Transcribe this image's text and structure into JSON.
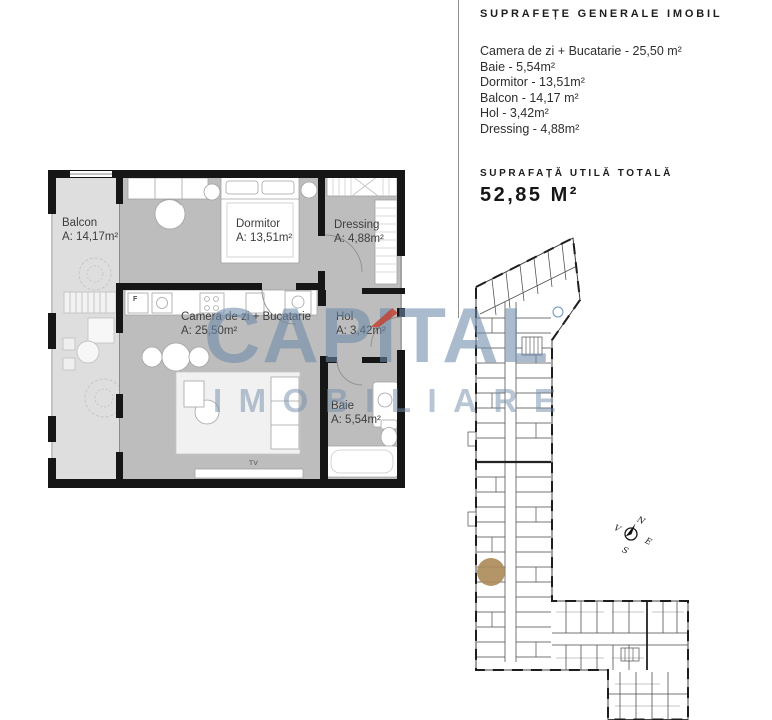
{
  "panel": {
    "title": "SUPRAFEȚE GENERALE IMOBIL",
    "items": [
      "Camera de zi + Bucatarie - 25,50 m²",
      "Baie - 5,54m²",
      "Dormitor - 13,51m²",
      "Balcon - 14,17 m²",
      "Hol - 3,42m²",
      "Dressing - 4,88m²"
    ],
    "total_label": "SUPRAFAȚĂ UTILĂ TOTALĂ",
    "total_value": "52,85 M²"
  },
  "floorplan": {
    "rooms": [
      {
        "id": "balcon",
        "name": "Balcon",
        "area": "A: 14,17m²"
      },
      {
        "id": "dormitor",
        "name": "Dormitor",
        "area": "A: 13,51m²"
      },
      {
        "id": "dressing",
        "name": "Dressing",
        "area": "A: 4,88m²"
      },
      {
        "id": "camera",
        "name": "Camera de zi + Bucatarie",
        "area": "A: 25,50m²"
      },
      {
        "id": "hol",
        "name": "Hol",
        "area": "A: 3,42m²"
      },
      {
        "id": "baie",
        "name": "Baie",
        "area": "A: 5,54m²"
      }
    ],
    "annotations": {
      "fridge": "F",
      "tv": "TV"
    }
  },
  "watermark": {
    "brand_pre": "CAP",
    "brand_accent": "I",
    "brand_post": "TAL",
    "brand_line2": "IMOBILIARE"
  },
  "site_plan": {
    "compass": {
      "north": "N",
      "east": "E",
      "south": "S",
      "west": "V"
    }
  },
  "colors": {
    "wall": "#161616",
    "room_fill": "#bdbdbd",
    "balcony_fill": "#dedede",
    "watermark_blue": "#6d8aaa",
    "accent_red": "#c43e30",
    "unit_marker": "#ab8a58",
    "site_line": "#424242"
  }
}
